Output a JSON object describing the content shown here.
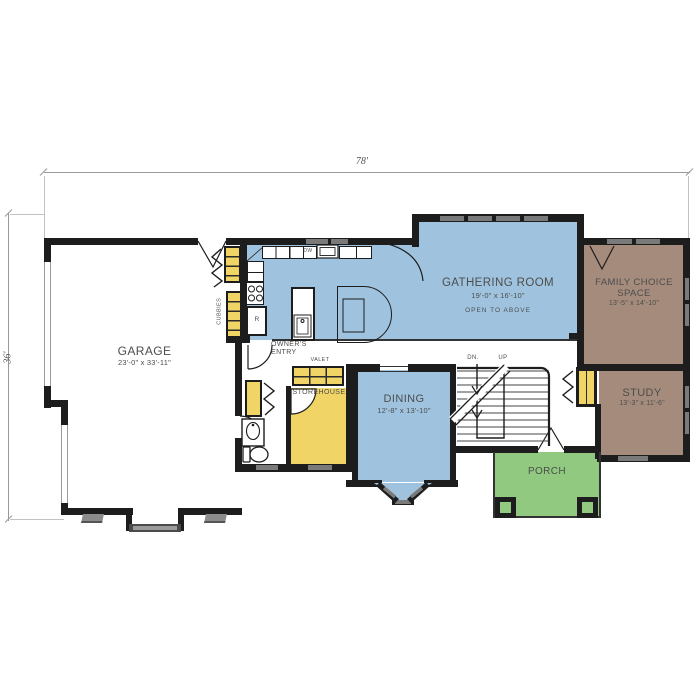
{
  "colors": {
    "room_blue": "#9fc3de",
    "room_brown": "#a58b7c",
    "room_yellow": "#f1d466",
    "room_green": "#90c97f",
    "wall": "#1d1d1d",
    "window_gray": "#7a7a7a",
    "label_text": "#4d4d4d",
    "dim_line": "#999999"
  },
  "dimensions": {
    "overall_width": "78'",
    "overall_depth": "36'"
  },
  "rooms": {
    "garage": {
      "name": "GARAGE",
      "dims": "23'-0\" x 33'-11\""
    },
    "gathering": {
      "name": "GATHERING ROOM",
      "dims": "19'-0\" x 16'-10\"",
      "note": "OPEN TO ABOVE"
    },
    "family_choice": {
      "name": "FAMILY CHOICE SPACE",
      "dims": "13'-5\" x 14'-10\""
    },
    "study": {
      "name": "STUDY",
      "dims": "13'-3\" x 11'-6\""
    },
    "dining": {
      "name": "DINING",
      "dims": "12'-8\" x 13'-10\""
    },
    "porch": {
      "name": "PORCH"
    },
    "owners_entry": {
      "name": "OWNER'S ENTRY"
    },
    "storehouse": {
      "name": "STOREHOUSE"
    },
    "valet": {
      "name": "VALET"
    },
    "cubbies": {
      "name": "CUBBIES"
    }
  },
  "stairs": {
    "down_label": "DN.",
    "up_label": "UP"
  },
  "appliances": {
    "refrigerator": "R",
    "dishwasher": "DW"
  }
}
